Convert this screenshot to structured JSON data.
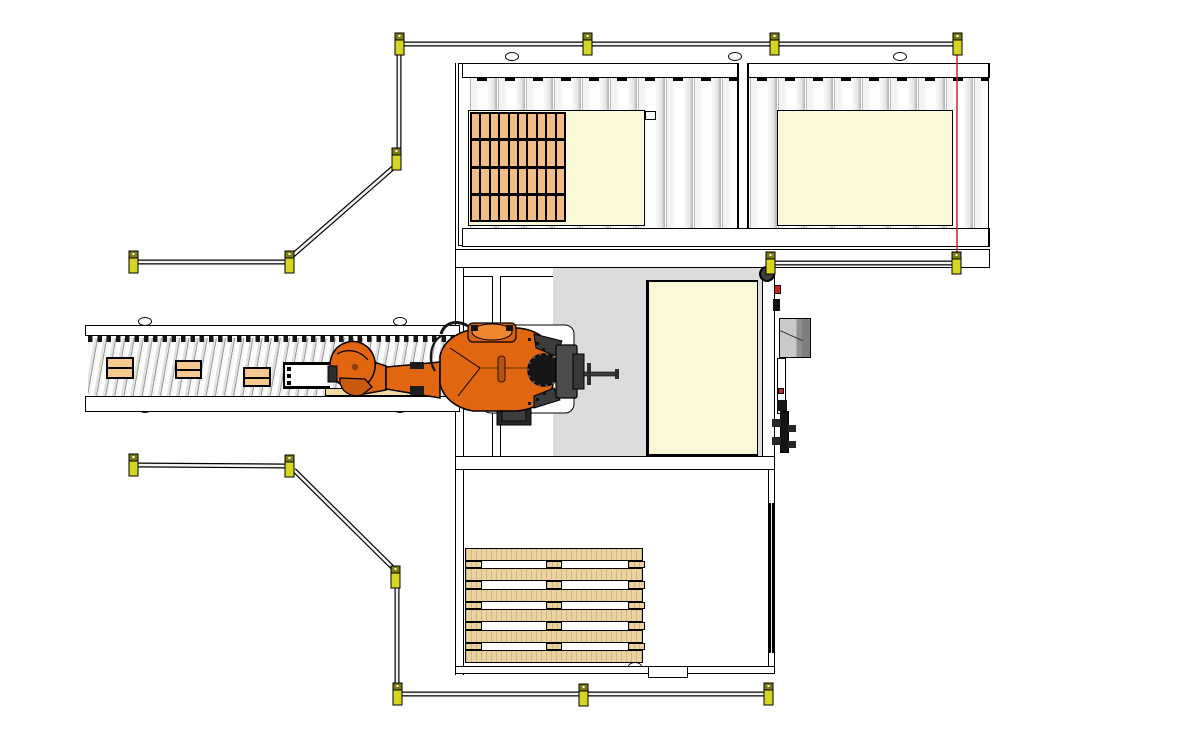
{
  "meta": {
    "description": "Top-down CAD layout of a robotic palletizing cell: infeed roller conveyor carrying cartons toward an orange industrial robot, two pallet stations on an outfeed roller conveyor (one stacked with cartons, one empty), a cream pallet stack station beside the robot, an empty wooden pallet in the south bay, yellow safety-fence posts with rails and a red light-curtain beam.",
    "canvas": {
      "width": 1181,
      "height": 737
    }
  },
  "colors": {
    "background": "#ffffff",
    "outline": "#000000",
    "post_yellow": "#d6d622",
    "post_cap": "#7d7d10",
    "post_dot": "#ffffff",
    "rail_core": "#f2f2f2",
    "light_curtain": "#cc2222",
    "floor_gray": "#dcdcdc",
    "cream": "#fbf8d8",
    "carton": "#f2bd85",
    "carton_box": "#f4c88e",
    "carton_strip": "#f5d7a3",
    "wood": "#ecd2a0",
    "roller_edge": "#b9b9b9",
    "robot_orange": "#e2660f",
    "metal_gray": "#4c4c4c",
    "device_gray": "#c9c9c7",
    "device_gray_dark": "#8f8f8d"
  },
  "fence": {
    "post_size": {
      "w": 9,
      "h": 22
    },
    "posts": [
      [
        395,
        33
      ],
      [
        583,
        33
      ],
      [
        770,
        33
      ],
      [
        953,
        33
      ],
      [
        392,
        148
      ],
      [
        285,
        251
      ],
      [
        129,
        251
      ],
      [
        766,
        252
      ],
      [
        952,
        252
      ],
      [
        129,
        454
      ],
      [
        285,
        455
      ],
      [
        391,
        566
      ],
      [
        393,
        683
      ],
      [
        579,
        684
      ],
      [
        764,
        683
      ]
    ],
    "rails": [
      [
        404,
        44,
        583,
        44
      ],
      [
        592,
        44,
        770,
        44
      ],
      [
        779,
        44,
        953,
        44
      ],
      [
        399,
        55,
        399,
        148
      ],
      [
        394,
        167,
        292,
        256
      ],
      [
        285,
        262,
        138,
        262
      ],
      [
        138,
        465,
        285,
        466
      ],
      [
        294,
        470,
        393,
        568
      ],
      [
        397,
        588,
        397,
        683
      ],
      [
        402,
        694,
        579,
        694
      ],
      [
        588,
        694,
        764,
        694
      ],
      [
        775,
        263,
        952,
        263
      ]
    ],
    "light_curtain": [
      957,
      55,
      957,
      258
    ]
  },
  "outfeed_conveyor": {
    "roller_pitch_px": 28,
    "frame": {
      "x": 455,
      "y": 60,
      "w": 535,
      "h": 202
    },
    "divider_x": 737,
    "slot_full": {
      "x": 468,
      "y": 110,
      "w": 177,
      "h": 116
    },
    "slot_empty": {
      "x": 777,
      "y": 110,
      "w": 176,
      "h": 116
    },
    "carton_stack": {
      "x": 470,
      "y": 112,
      "w": 96,
      "h": 110,
      "rows": 4,
      "cols": 10
    }
  },
  "infeed_conveyor": {
    "frame": {
      "x": 85,
      "y": 320,
      "w": 375,
      "h": 93
    },
    "boxes": [
      [
        106,
        357,
        28,
        22
      ],
      [
        175,
        360,
        27,
        19
      ],
      [
        243,
        367,
        28,
        20
      ]
    ],
    "cutout": {
      "x": 283,
      "y": 362,
      "w": 47,
      "h": 27
    },
    "under_strip": [
      325,
      388,
      107,
      8
    ]
  },
  "stations": {
    "robot_side_pallet": {
      "x": 646,
      "y": 280,
      "w": 112,
      "h": 177
    },
    "floor_plate": {
      "x": 553,
      "y": 268,
      "w": 217,
      "h": 200
    }
  },
  "south_bay": {
    "empty_pallet": {
      "x": 465,
      "y": 548,
      "w": 178,
      "h": 115,
      "planks": 6,
      "gap_blocks": [
        [
          0,
          0.085
        ],
        [
          0.455,
          0.535
        ],
        [
          0.915,
          1.0
        ]
      ]
    }
  },
  "feet": [
    [
      512,
      56
    ],
    [
      735,
      56
    ],
    [
      900,
      56
    ],
    [
      478,
      262
    ],
    [
      752,
      262
    ],
    [
      478,
      464
    ],
    [
      752,
      464
    ],
    [
      145,
      321
    ],
    [
      400,
      321
    ],
    [
      145,
      408
    ],
    [
      400,
      408
    ],
    [
      635,
      666
    ]
  ]
}
